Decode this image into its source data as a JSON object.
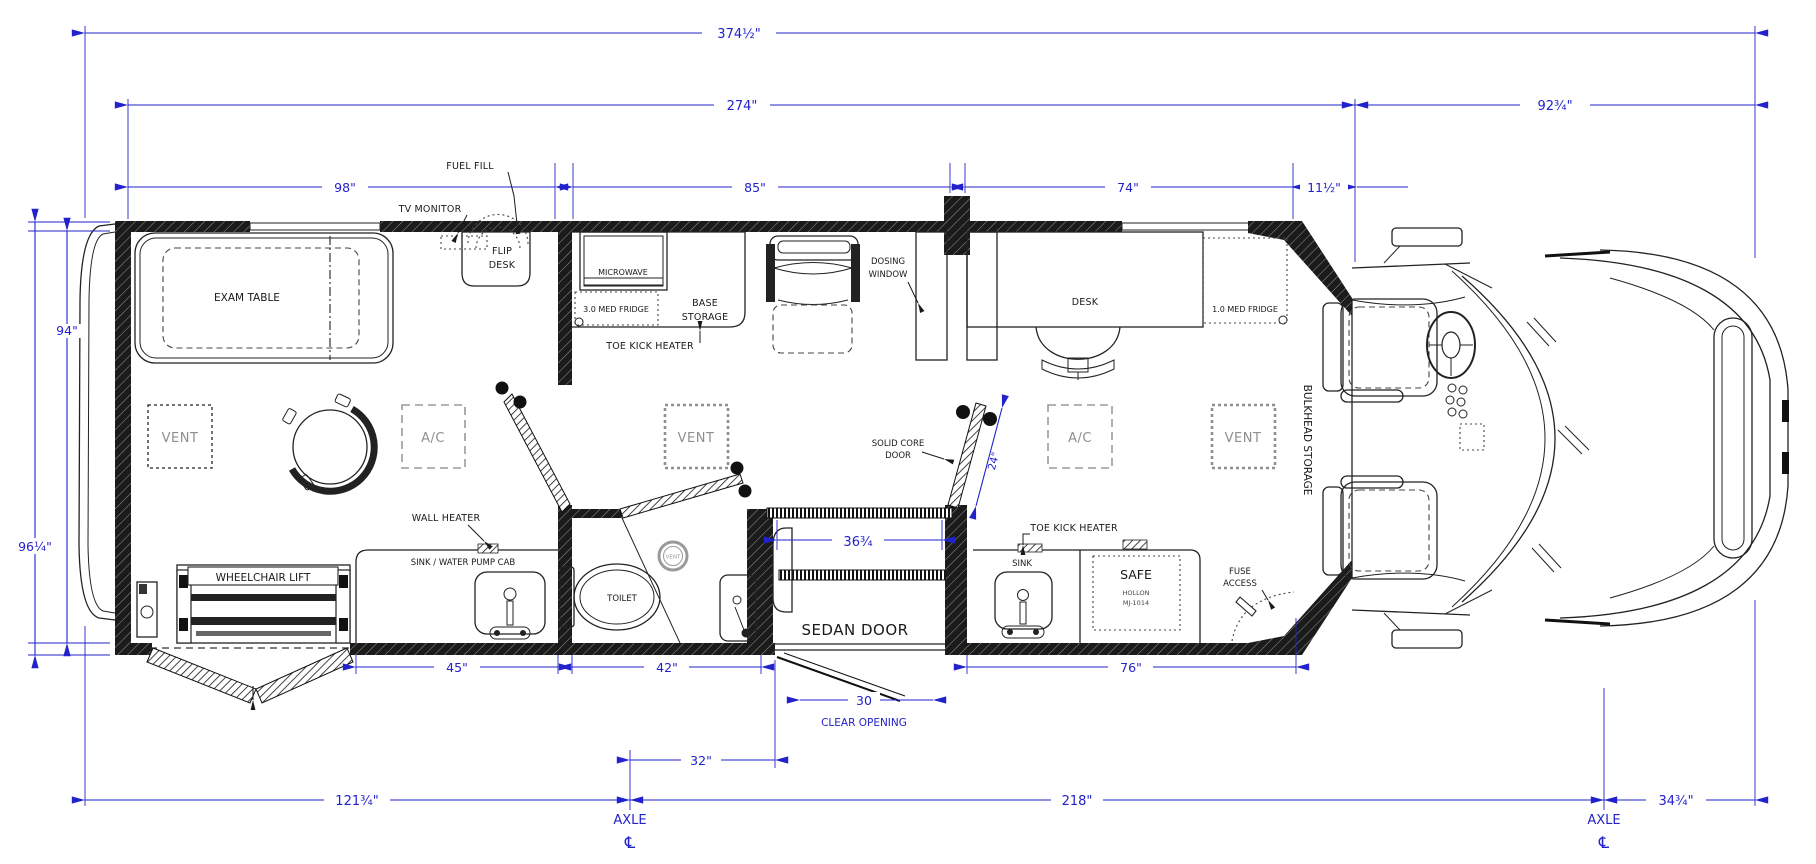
{
  "colors": {
    "dimension_blue": "#2222cc",
    "label_black": "#1a1a1a",
    "equipment_gray": "#8f8f8f",
    "wall_black": "#151515"
  },
  "dims": {
    "overall_length": "374½\"",
    "body_length": "274\"",
    "front_length": "92¾\"",
    "exam_room": "98\"",
    "mid_room": "85\"",
    "office_room": "74\"",
    "bulkhead_depth": "11½\"",
    "interior_width": "94\"",
    "overall_width": "96¼\"",
    "sink_cab_width": "45\"",
    "bath_width": "42\"",
    "right_cab_width": "76\"",
    "sedan_opening": "36¾",
    "door_leaf": "24\"",
    "clear_opening_value": "30",
    "clear_opening_label": "CLEAR OPENING",
    "rear_to_axle": "121¾\"",
    "axle_to_door": "32\"",
    "wheelbase": "218\"",
    "axle_to_front": "34¾\"",
    "axle_label": "AXLE",
    "centerline_symbol": "℄"
  },
  "labels": {
    "fuel_fill": "FUEL FILL",
    "tv_monitor": "TV MONITOR",
    "flip_desk": [
      "FLIP",
      "DESK"
    ],
    "exam_table": "EXAM TABLE",
    "vent": "VENT",
    "ac": "A/C",
    "microwave": "MICROWAVE",
    "med_fridge_3": "3.0 MED FRIDGE",
    "base_storage": [
      "BASE",
      "STORAGE"
    ],
    "toe_kick_heater": "TOE KICK HEATER",
    "dosing_window": [
      "DOSING",
      "WINDOW"
    ],
    "desk": "DESK",
    "med_fridge_1": "1.0 MED FRIDGE",
    "solid_core_door": [
      "SOLID CORE",
      "DOOR"
    ],
    "wall_heater": "WALL HEATER",
    "sink_water_pump_cab": "SINK / WATER PUMP CAB",
    "wheelchair_lift": "WHEELCHAIR LIFT",
    "toilet": "TOILET",
    "sedan_door": "SEDAN DOOR",
    "sink": "SINK",
    "safe": "SAFE",
    "safe_brand": "HOLLON",
    "safe_model": "MJ-1014",
    "fuse_access": [
      "FUSE",
      "ACCESS"
    ],
    "bulkhead_storage": "BULKHEAD STORAGE",
    "vent_small": "VENT"
  }
}
